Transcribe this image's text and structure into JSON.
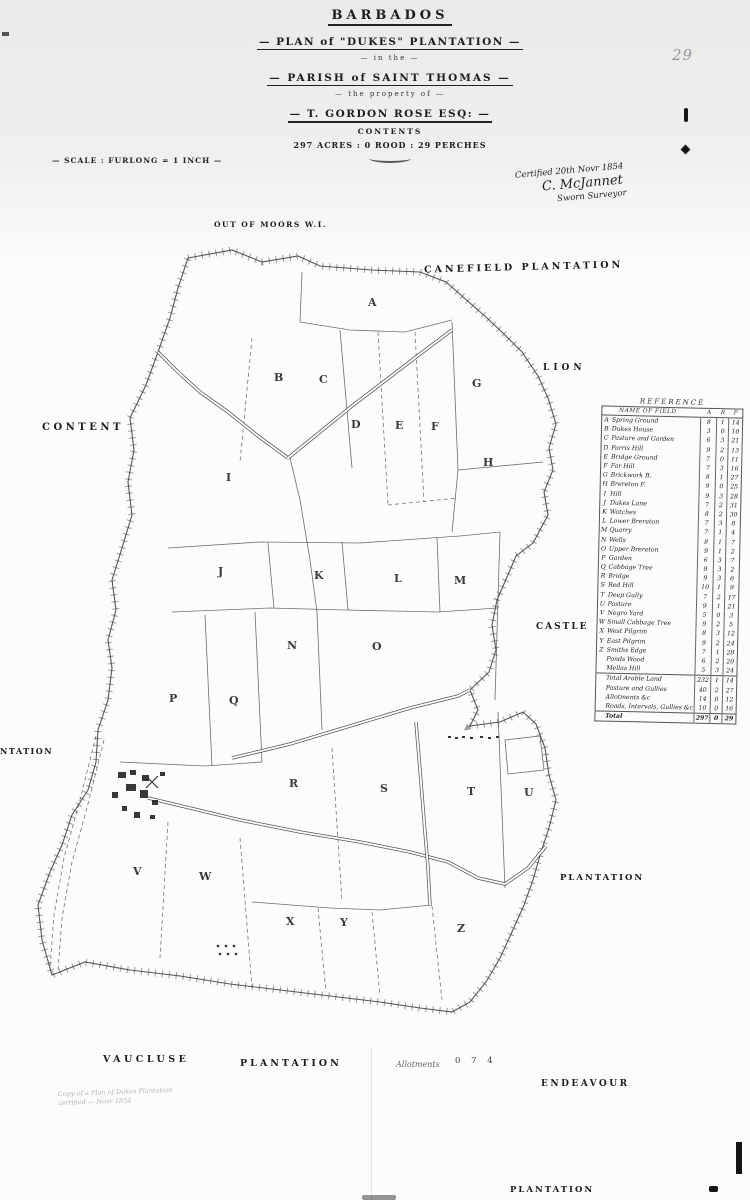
{
  "page": {
    "number_mark": "29"
  },
  "title_block": {
    "country": "BARBADOS",
    "plan_line": "— PLAN of \"DUKES\" PLANTATION —",
    "in_the": "— in the —",
    "parish_line": "— PARISH of SAINT THOMAS —",
    "property_of": "— the property of —",
    "owner_line": "— T. GORDON ROSE ESQ: —",
    "contents_label": "CONTENTS",
    "acreage_line": "297 ACRES : 0 ROOD : 29 PERCHES"
  },
  "scale_note": "— SCALE : FURLONG = 1 INCH —",
  "certification": {
    "line1": "Certified 20th Novr 1854",
    "signature": "C. McJannet",
    "line3": "Sworn Surveyor"
  },
  "annotations": {
    "out_of_moors": "OUT OF MOORS W.I.",
    "allotments": "Allotments",
    "allotments_numbers": "0 7 4",
    "copy_note_line1": "Copy of a Plan of Dukes Plantation",
    "copy_note_line2": "certified — Novr 1854"
  },
  "neighbors": {
    "north": "CANEFIELD   PLANTATION",
    "west": "CONTENT",
    "west_partial": "NTATION",
    "east_upper": "LION",
    "east_middle": "CASTLE",
    "east_lower": "PLANTATION",
    "south_west": "VAUCLUSE",
    "south": "PLANTATION",
    "south_east": "ENDEAVOUR",
    "south_east2": "PLANTATION"
  },
  "map": {
    "parcels": [
      {
        "letter": "A",
        "x": 368,
        "y": 306
      },
      {
        "letter": "B",
        "x": 274,
        "y": 381
      },
      {
        "letter": "C",
        "x": 319,
        "y": 383
      },
      {
        "letter": "D",
        "x": 351,
        "y": 428
      },
      {
        "letter": "E",
        "x": 395,
        "y": 429
      },
      {
        "letter": "F",
        "x": 431,
        "y": 430
      },
      {
        "letter": "G",
        "x": 472,
        "y": 387
      },
      {
        "letter": "H",
        "x": 483,
        "y": 466
      },
      {
        "letter": "I",
        "x": 226,
        "y": 481
      },
      {
        "letter": "J",
        "x": 218,
        "y": 575
      },
      {
        "letter": "K",
        "x": 314,
        "y": 579
      },
      {
        "letter": "L",
        "x": 394,
        "y": 582
      },
      {
        "letter": "M",
        "x": 454,
        "y": 584
      },
      {
        "letter": "N",
        "x": 287,
        "y": 649
      },
      {
        "letter": "O",
        "x": 372,
        "y": 650
      },
      {
        "letter": "P",
        "x": 169,
        "y": 702
      },
      {
        "letter": "Q",
        "x": 229,
        "y": 704
      },
      {
        "letter": "R",
        "x": 289,
        "y": 787
      },
      {
        "letter": "S",
        "x": 380,
        "y": 792
      },
      {
        "letter": "T",
        "x": 467,
        "y": 795
      },
      {
        "letter": "U",
        "x": 524,
        "y": 796
      },
      {
        "letter": "V",
        "x": 133,
        "y": 875
      },
      {
        "letter": "W",
        "x": 199,
        "y": 880
      },
      {
        "letter": "X",
        "x": 286,
        "y": 925
      },
      {
        "letter": "Y",
        "x": 340,
        "y": 926
      },
      {
        "letter": "Z",
        "x": 457,
        "y": 932
      }
    ]
  },
  "reference_table": {
    "title": "REFERENCE",
    "name_header": "NAME OF FIELD",
    "unit_headers": [
      "A",
      "R",
      "P"
    ],
    "rows": [
      {
        "key": "A",
        "name": "Spring Ground",
        "a": "8",
        "r": "1",
        "p": "14"
      },
      {
        "key": "B",
        "name": "Dukes House",
        "a": "3",
        "r": "0",
        "p": "10"
      },
      {
        "key": "C",
        "name": "Pasture and Garden",
        "a": "6",
        "r": "3",
        "p": "21"
      },
      {
        "key": "D",
        "name": "Parris Hill",
        "a": "9",
        "r": "2",
        "p": "13"
      },
      {
        "key": "E",
        "name": "Bridge Ground",
        "a": "7",
        "r": "0",
        "p": "11"
      },
      {
        "key": "F",
        "name": "Far Hill",
        "a": "7",
        "r": "3",
        "p": "16"
      },
      {
        "key": "G",
        "name": "Brickwork B.",
        "a": "8",
        "r": "1",
        "p": "27"
      },
      {
        "key": "H",
        "name": "Brereton F.",
        "a": "9",
        "r": "0",
        "p": "25"
      },
      {
        "key": "I",
        "name": "Hill",
        "a": "9",
        "r": "3",
        "p": "28"
      },
      {
        "key": "J",
        "name": "Dukes Lane",
        "a": "7",
        "r": "2",
        "p": "31"
      },
      {
        "key": "K",
        "name": "Watches",
        "a": "8",
        "r": "2",
        "p": "30"
      },
      {
        "key": "L",
        "name": "Lower Brereton",
        "a": "7",
        "r": "3",
        "p": "8"
      },
      {
        "key": "M",
        "name": "Quarry",
        "a": "7",
        "r": "1",
        "p": "4"
      },
      {
        "key": "N",
        "name": "Wells",
        "a": "8",
        "r": "1",
        "p": "7"
      },
      {
        "key": "O",
        "name": "Upper Brereton",
        "a": "9",
        "r": "1",
        "p": "2"
      },
      {
        "key": "P",
        "name": "Garden",
        "a": "6",
        "r": "3",
        "p": "7"
      },
      {
        "key": "Q",
        "name": "Cabbage Tree",
        "a": "8",
        "r": "3",
        "p": "2"
      },
      {
        "key": "R",
        "name": "Bridge",
        "a": "9",
        "r": "3",
        "p": "6"
      },
      {
        "key": "S",
        "name": "Red Hill",
        "a": "10",
        "r": "1",
        "p": "9"
      },
      {
        "key": "T",
        "name": "Deep Gully",
        "a": "7",
        "r": "2",
        "p": "17"
      },
      {
        "key": "U",
        "name": "Pasture",
        "a": "9",
        "r": "1",
        "p": "21"
      },
      {
        "key": "V",
        "name": "Negro Yard",
        "a": "5",
        "r": "0",
        "p": "3"
      },
      {
        "key": "W",
        "name": "Small Cabbage Tree",
        "a": "9",
        "r": "2",
        "p": "5"
      },
      {
        "key": "X",
        "name": "West Pilgrim",
        "a": "8",
        "r": "3",
        "p": "12"
      },
      {
        "key": "Y",
        "name": "East Pilgrim",
        "a": "9",
        "r": "2",
        "p": "24"
      },
      {
        "key": "Z",
        "name": "Smiths Edge",
        "a": "7",
        "r": "1",
        "p": "28"
      },
      {
        "key": "",
        "name": "Ponds Wood",
        "a": "6",
        "r": "2",
        "p": "20"
      },
      {
        "key": "",
        "name": "Mellas Hill",
        "a": "5",
        "r": "3",
        "p": "24"
      }
    ],
    "summary": [
      {
        "key": "",
        "name": "Total Arable Land",
        "a": "232",
        "r": "1",
        "p": "14"
      },
      {
        "key": "",
        "name": "Pasture and Gullies",
        "a": "40",
        "r": "2",
        "p": "27"
      },
      {
        "key": "",
        "name": "Allotments &c",
        "a": "14",
        "r": "0",
        "p": "12"
      },
      {
        "key": "",
        "name": "Roads, Intervals, Gullies &c",
        "a": "10",
        "r": "0",
        "p": "16"
      }
    ],
    "total": {
      "key": "",
      "name": "Total",
      "a": "297",
      "r": "0",
      "p": "29"
    }
  }
}
